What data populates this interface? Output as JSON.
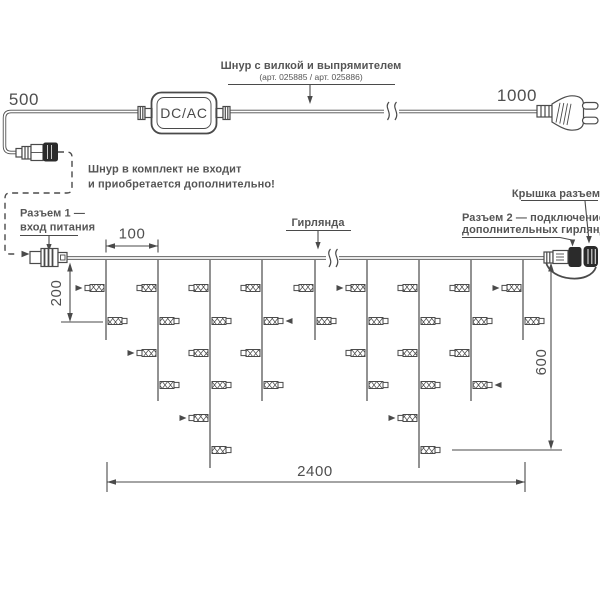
{
  "labels": {
    "dcac": "DC/AC",
    "cord_title": "Шнур с вилкой и выпрямителем",
    "cord_subtitle": "(арт. 025885 / арт. 025886)",
    "note_line1": "Шнур в комплект не входит",
    "note_line2": "и приобретается дополнительно!",
    "connector1_line1": "Разъем 1 —",
    "connector1_line2": "вход питания",
    "garland": "Гирлянда",
    "cap": "Крышка разъема",
    "connector2_line1": "Разъем 2 — подключение",
    "connector2_line2": "дополнительных гирлянд"
  },
  "dimensions": {
    "cord_left": "500",
    "cord_right": "1000",
    "drop_spacing": "100",
    "drop_short": "200",
    "drop_long": "600",
    "garland_length": "2400"
  },
  "colors": {
    "line": "#4a4a4a",
    "text": "#4f4f4f",
    "connector_cap": "#2b2b2b",
    "background": "#ffffff"
  },
  "diagram": {
    "wire_y": 258,
    "lamp_rows": [
      288,
      321,
      353,
      385,
      418,
      450
    ],
    "drops": [
      {
        "x": 106,
        "end": 340,
        "lamps": [
          {
            "y": 288,
            "side": "L",
            "arrow": true
          },
          {
            "y": 321,
            "side": "R"
          }
        ]
      },
      {
        "x": 158,
        "end": 401,
        "lamps": [
          {
            "y": 288,
            "side": "L"
          },
          {
            "y": 321,
            "side": "R"
          },
          {
            "y": 353,
            "side": "L",
            "arrow": true
          },
          {
            "y": 385,
            "side": "R"
          }
        ]
      },
      {
        "x": 210,
        "end": 468,
        "lamps": [
          {
            "y": 288,
            "side": "L"
          },
          {
            "y": 321,
            "side": "R"
          },
          {
            "y": 353,
            "side": "L"
          },
          {
            "y": 385,
            "side": "R"
          },
          {
            "y": 418,
            "side": "L",
            "arrow": true
          },
          {
            "y": 450,
            "side": "R"
          }
        ]
      },
      {
        "x": 262,
        "end": 401,
        "lamps": [
          {
            "y": 288,
            "side": "L"
          },
          {
            "y": 321,
            "side": "R",
            "arrow": true
          },
          {
            "y": 353,
            "side": "L"
          },
          {
            "y": 385,
            "side": "R"
          }
        ]
      },
      {
        "x": 315,
        "end": 340,
        "lamps": [
          {
            "y": 288,
            "side": "L"
          },
          {
            "y": 321,
            "side": "R"
          }
        ]
      },
      {
        "x": 367,
        "end": 401,
        "lamps": [
          {
            "y": 288,
            "side": "L",
            "arrow": true
          },
          {
            "y": 321,
            "side": "R"
          },
          {
            "y": 353,
            "side": "L"
          },
          {
            "y": 385,
            "side": "R"
          }
        ]
      },
      {
        "x": 419,
        "end": 468,
        "lamps": [
          {
            "y": 288,
            "side": "L"
          },
          {
            "y": 321,
            "side": "R"
          },
          {
            "y": 353,
            "side": "L"
          },
          {
            "y": 385,
            "side": "R"
          },
          {
            "y": 418,
            "side": "L",
            "arrow": true
          },
          {
            "y": 450,
            "side": "R"
          }
        ]
      },
      {
        "x": 471,
        "end": 401,
        "lamps": [
          {
            "y": 288,
            "side": "L"
          },
          {
            "y": 321,
            "side": "R"
          },
          {
            "y": 353,
            "side": "L"
          },
          {
            "y": 385,
            "side": "R",
            "arrow": true
          }
        ]
      },
      {
        "x": 523,
        "end": 340,
        "lamps": [
          {
            "y": 288,
            "side": "L",
            "arrow": true
          },
          {
            "y": 321,
            "side": "R"
          }
        ]
      }
    ]
  }
}
